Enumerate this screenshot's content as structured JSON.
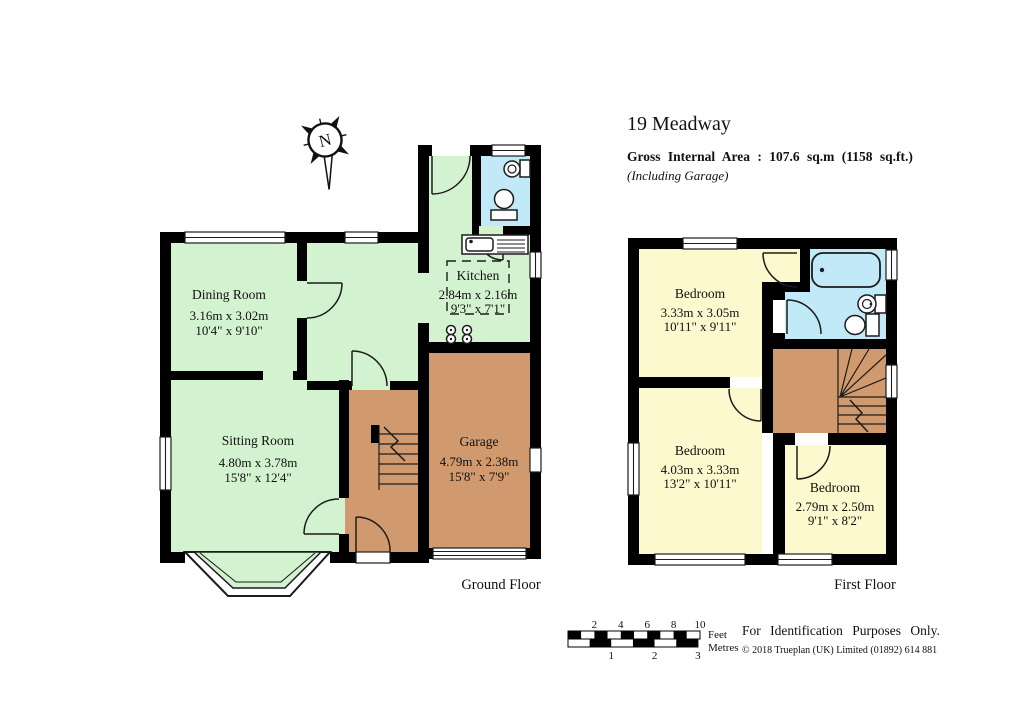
{
  "title": "19 Meadway",
  "header": {
    "gross_area": "Gross Internal Area : 107.6 sq.m (1158 sq.ft.)",
    "note": "(Including Garage)"
  },
  "compass": {
    "north": "N"
  },
  "ground_floor": {
    "label": "Ground Floor",
    "rooms": {
      "dining": {
        "name": "Dining Room",
        "metric": "3.16m x 3.02m",
        "imperial": "10'4\" x 9'10\""
      },
      "sitting": {
        "name": "Sitting Room",
        "metric": "4.80m x 3.78m",
        "imperial": "15'8\" x 12'4\""
      },
      "kitchen": {
        "name": "Kitchen",
        "metric": "2.84m x 2.16m",
        "imperial": "9'3\" x 7'1\""
      },
      "garage": {
        "name": "Garage",
        "metric": "4.79m x 2.38m",
        "imperial": "15'8\" x 7'9\""
      }
    }
  },
  "first_floor": {
    "label": "First Floor",
    "rooms": {
      "bedroom1": {
        "name": "Bedroom",
        "metric": "3.33m x 3.05m",
        "imperial": "10'11\" x 9'11\""
      },
      "bedroom2": {
        "name": "Bedroom",
        "metric": "4.03m x 3.33m",
        "imperial": "13'2\" x 10'11\""
      },
      "bedroom3": {
        "name": "Bedroom",
        "metric": "2.79m x 2.50m",
        "imperial": "9'1\" x 8'2\""
      }
    }
  },
  "scale": {
    "feet_label": "Feet",
    "metres_label": "Metres",
    "feet_ticks": [
      "2",
      "4",
      "6",
      "8",
      "10"
    ],
    "metre_ticks": [
      "1",
      "2",
      "3"
    ]
  },
  "footer": {
    "purpose": "For Identification Purposes Only.",
    "copyright": "© 2018 Trueplan (UK) Limited  (01892) 614 881"
  },
  "colors": {
    "room_green": "#d3f2cf",
    "room_yellow": "#fbf9cd",
    "room_blue": "#c2e9f7",
    "room_brown": "#d19a6e",
    "wall": "#000000",
    "line": "#1c1c1c",
    "text": "#111111"
  }
}
